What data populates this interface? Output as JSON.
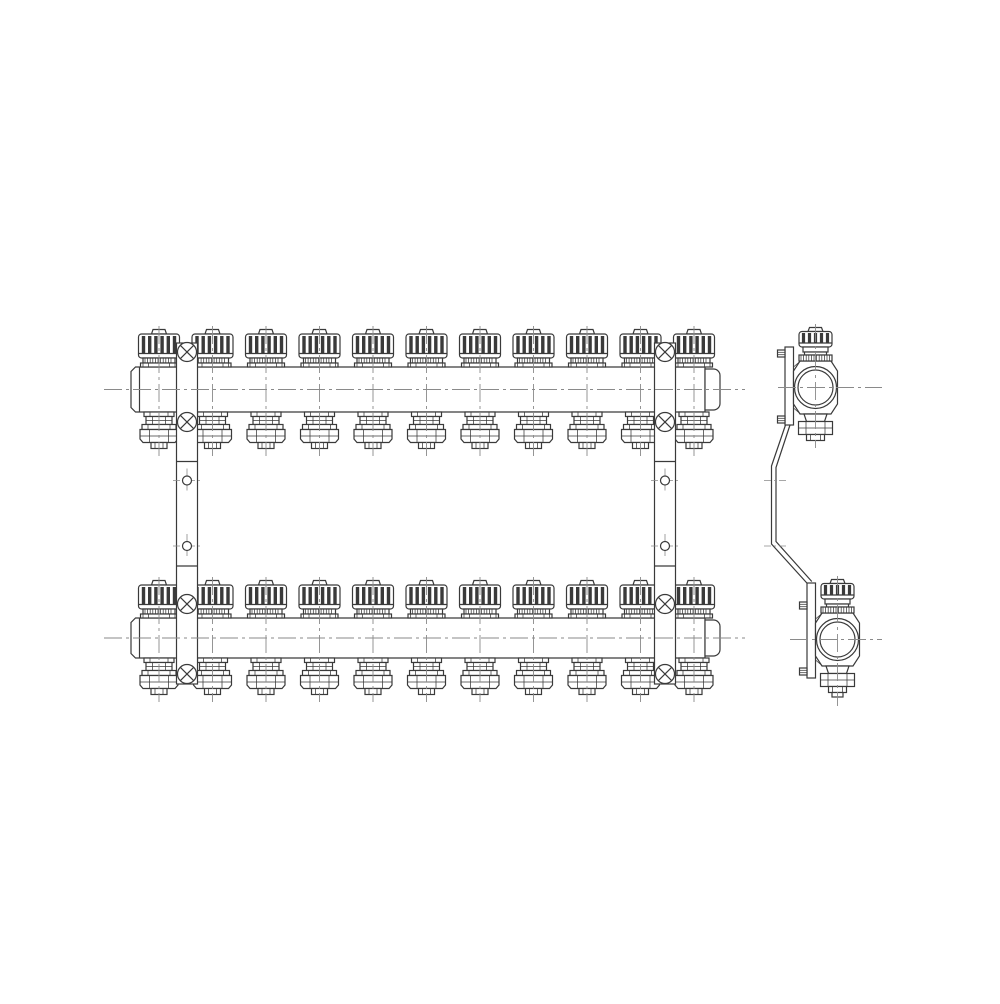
{
  "drawing": {
    "kind": "technical-line-drawing",
    "subject": "radiant-heating-manifold-assembly",
    "colors": {
      "background": "#ffffff",
      "ink": "#3a3a3a",
      "centerline": "#8a8a8a"
    },
    "front_view": {
      "circuits_per_manifold": 11,
      "valve_centers_x": [
        159,
        212.5,
        266,
        319.5,
        373,
        426.5,
        480,
        533.5,
        587,
        640.5,
        694
      ],
      "manifolds": [
        {
          "name": "top-manifold-bar",
          "bar": {
            "x": 131,
            "y": 367,
            "w": 574,
            "h": 45
          },
          "cap": {
            "x": 705,
            "y": 369,
            "w": 15,
            "h": 41
          },
          "centerline": {
            "x1": 104,
            "x2": 745
          }
        },
        {
          "name": "bottom-manifold-bar",
          "bar": {
            "x": 131,
            "y": 618,
            "w": 574,
            "h": 40
          },
          "cap": {
            "x": 705,
            "y": 620,
            "w": 15,
            "h": 36
          },
          "centerline": {
            "x1": 104,
            "x2": 745
          }
        }
      ],
      "mounting_brackets": [
        {
          "name": "left-mounting-bracket",
          "x": 176.5,
          "w": 21,
          "top": 343,
          "bottom": 684,
          "screws_cy": [
            352,
            422,
            604,
            674
          ],
          "holes_cy": [
            480.5,
            546
          ],
          "joints_y": [
            461.5,
            566
          ]
        },
        {
          "name": "right-mounting-bracket",
          "x": 654.5,
          "w": 21,
          "top": 343,
          "bottom": 684,
          "screws_cy": [
            352,
            422,
            604,
            674
          ],
          "holes_cy": [
            480.5,
            546
          ],
          "joints_y": [
            461.5,
            566
          ]
        }
      ]
    },
    "side_view": {
      "valves": [
        {
          "name": "side-top-section",
          "cx": 815.5,
          "cy": 387.5,
          "outer_r": 21,
          "inner_r": 17.5,
          "plate": {
            "x": 785,
            "y": 347,
            "w": 8.5,
            "h": 78
          },
          "screws_cy": [
            353.5,
            419.5
          ],
          "has_tip": false
        },
        {
          "name": "side-bottom-section",
          "cx": 837.5,
          "cy": 639.5,
          "outer_r": 21,
          "inner_r": 17.5,
          "plate": {
            "x": 807,
            "y": 583,
            "w": 8.5,
            "h": 95
          },
          "screws_cy": [
            605.5,
            671.5
          ],
          "has_tip": true
        }
      ],
      "strap_outer": [
        [
          785.5,
          425
        ],
        [
          771.5,
          466
        ],
        [
          771.5,
          544
        ],
        [
          807.3,
          583.5
        ]
      ],
      "strap_inner": [
        [
          790,
          425
        ],
        [
          776,
          467.5
        ],
        [
          776,
          541.5
        ],
        [
          811.8,
          581.5
        ]
      ],
      "strap_ticks_y": [
        480.5,
        546
      ],
      "strap_tick_x": [
        764,
        788
      ],
      "centerlines": {
        "top": {
          "x1": 778,
          "x2": 882
        },
        "bottom": {
          "x1": 790,
          "x2": 882
        }
      }
    }
  }
}
